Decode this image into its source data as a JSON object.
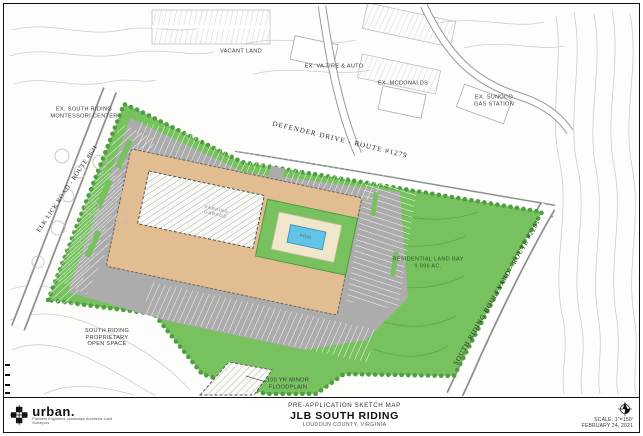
{
  "sheet": {
    "map_labels": {
      "vacant_land": "VACANT LAND",
      "va_tire": "EX. VA TIRE & AUTO",
      "mcdonalds": "EX. MCDONALDS",
      "sunoco_1": "EX. SUNOCO",
      "sunoco_2": "GAS STATION",
      "montessori_1": "EX. SOUTH RIDING",
      "montessori_2": "MONTESSORI CENTER",
      "defender_drive": "DEFENDER DRIVE - ROUTE #1279",
      "elk_lick_road": "ELK LICK ROAD - ROUTE #621",
      "south_riding_blvd": "SOUTH RIDING BOULEVARD - ROUTE #2201",
      "land_bay_1": "RESIDENTIAL LAND BAY",
      "land_bay_2": "9.996 AC.",
      "open_space_1": "SOUTH RIDING",
      "open_space_2": "PROPRIETARY",
      "open_space_3": "OPEN SPACE",
      "floodplain_1": "100 YR MINOR",
      "floodplain_2": "FLOODPLAIN",
      "pool": "POOL",
      "garage_1": "PARKING",
      "garage_2": "GARAGE"
    },
    "title_block": {
      "logo_text": "urban.",
      "logo_tagline": "Planners Engineers Landscape Architects Land Surveyors",
      "doc_type": "PRE-APPLICATION SKETCH MAP",
      "title": "JLB SOUTH RIDING",
      "location": "LOUDOUN COUNTY, VIRGINIA",
      "scale": "SCALE: 1\"=150'",
      "date": "FEBRUARY 24, 2021"
    },
    "colors": {
      "site_green": "#77c25f",
      "tree_green": "#4f9e41",
      "building_tan": "#e3bd92",
      "parking_gray": "#acacac",
      "pool_blue": "#62c3e8",
      "pool_deck": "#f0e6cc"
    }
  }
}
